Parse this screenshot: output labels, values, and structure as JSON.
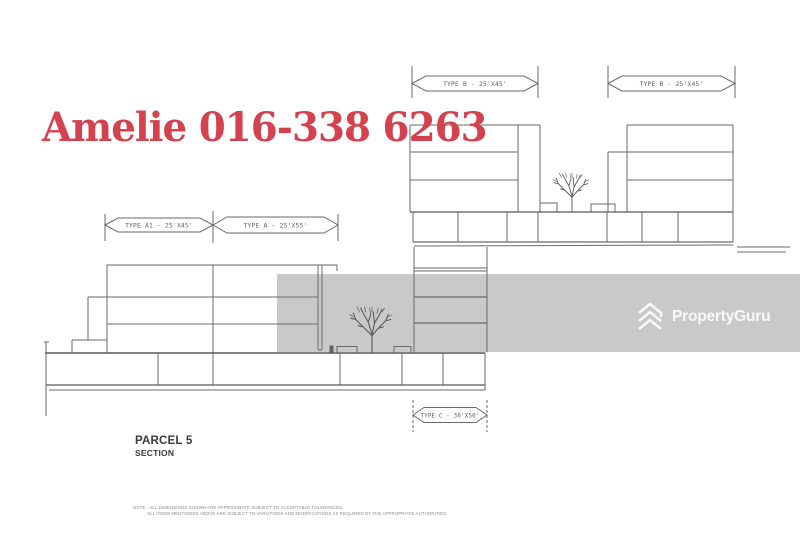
{
  "overlay": {
    "agent_text": "Amelie 016-338 6263"
  },
  "watermark": {
    "brand": "PropertyGuru"
  },
  "drawing": {
    "tags": {
      "type_a1": "TYPE A1 - 25'X45'",
      "type_a": "TYPE A - 25'X55'",
      "type_b_left": "TYPE B - 25'X45'",
      "type_b_right": "TYPE B - 25'X45'",
      "type_c": "TYPE C - 30'X50'"
    },
    "title": "PARCEL 5",
    "subtitle": "SECTION",
    "note_line1": "NOTE : ALL DIMENSIONS SHOWN ARE APPROXIMATE SUBJECT TO ACCEPTABLE TOLERANCES.",
    "note_line2": "ALL ITEMS MENTIONED ABOVE ARE SUBJECT TO VARIATIONS AND MODIFICATIONS AS REQUIRED BY THE APPROPRIATE AUTHORITIES."
  },
  "colors": {
    "accent_red": "#d4414f",
    "watermark_band": "#c9c9c9",
    "line": "#666666"
  }
}
